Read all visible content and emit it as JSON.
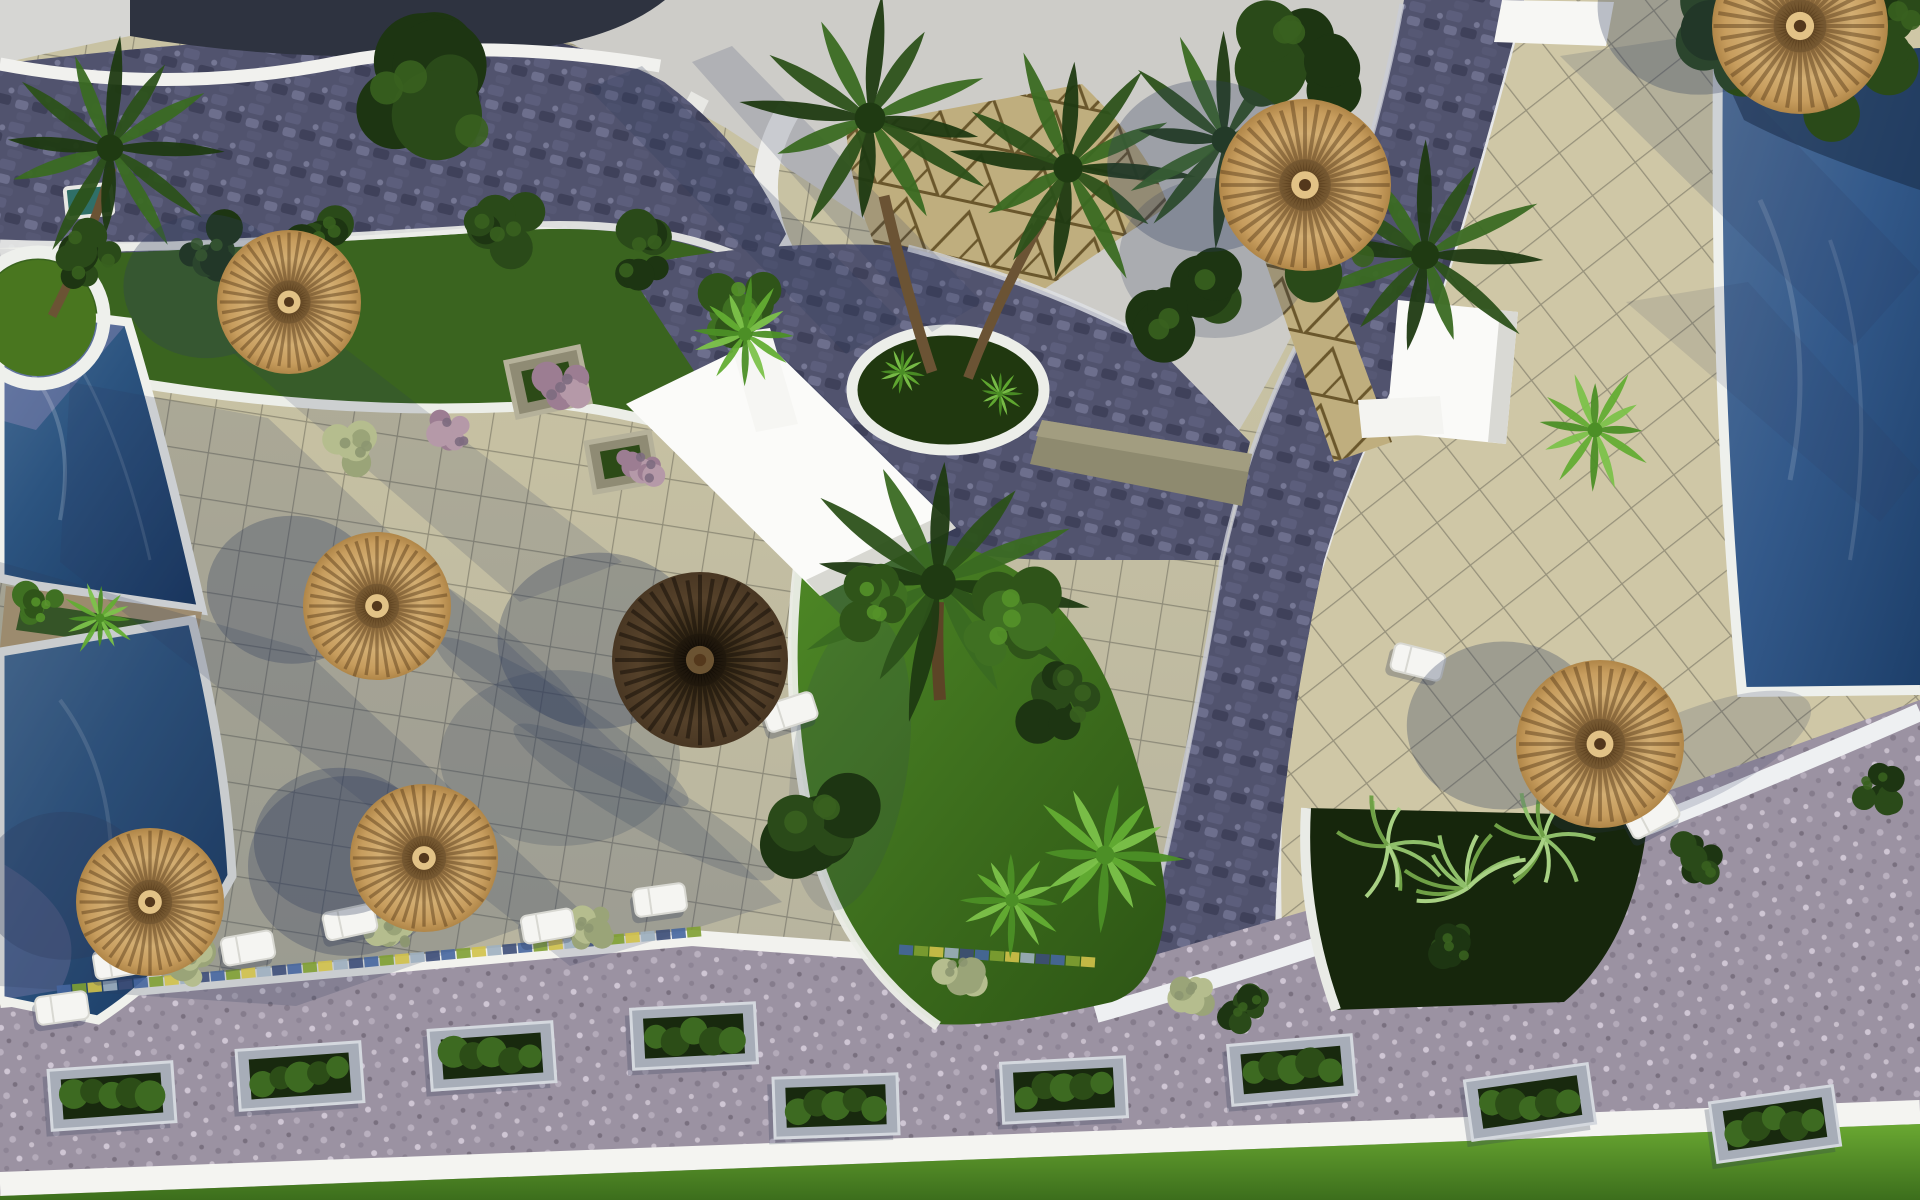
{
  "scene": {
    "title": "aerial-render-resort-courtyard-with-pools-palms-and-thatch-umbrellas",
    "palette": {
      "tile_base": "#c8c2a3",
      "tile_base_right": "#cfc7a6",
      "grout": "#827e6a",
      "cobble_base": "#51536e",
      "cobble_hi": "#6d6f8d",
      "cobble_lo": "#3f415a",
      "road_base": "#9b92a2",
      "road_hi": "#c3bac9",
      "road_lo": "#8a8191",
      "roof_gray": "#cdccc8",
      "white_wall": "#f2f2ee",
      "water_deep": "#15345c",
      "water_mid": "#2c5480",
      "water_light": "#4a6f96",
      "lawn_dark": "#2c5414",
      "lawn_light": "#4e8826",
      "grass_bright": "#6aa832",
      "thatch_light": "#d3ae72",
      "thatch_mid": "#a8834f",
      "thatch_dark_center": "#7e5f35",
      "thatch_brown": "#3a2d18",
      "trunk": "#6b5334",
      "stone": "#8e8a6f",
      "shadow": "#2e3a5c",
      "tri_tile": "#bfae7e",
      "tri_line": "#6a572c"
    },
    "umbrellas": [
      {
        "x": 289,
        "y": 302,
        "r": 72,
        "type": "tan"
      },
      {
        "x": 377,
        "y": 606,
        "r": 74,
        "type": "tan"
      },
      {
        "x": 150,
        "y": 902,
        "r": 74,
        "type": "tan"
      },
      {
        "x": 424,
        "y": 858,
        "r": 74,
        "type": "tan"
      },
      {
        "x": 700,
        "y": 660,
        "r": 88,
        "type": "dark"
      },
      {
        "x": 1305,
        "y": 185,
        "r": 86,
        "type": "tan"
      },
      {
        "x": 1600,
        "y": 744,
        "r": 84,
        "type": "tan"
      },
      {
        "x": 1800,
        "y": 26,
        "r": 88,
        "type": "tan"
      }
    ],
    "loungers": [
      {
        "x": 62,
        "y": 1008,
        "rot": -8
      },
      {
        "x": 120,
        "y": 962,
        "rot": -9
      },
      {
        "x": 248,
        "y": 948,
        "rot": -10
      },
      {
        "x": 350,
        "y": 922,
        "rot": -12
      },
      {
        "x": 548,
        "y": 926,
        "rot": -10
      },
      {
        "x": 660,
        "y": 900,
        "rot": -8
      },
      {
        "x": 790,
        "y": 712,
        "rot": -18
      },
      {
        "x": 1418,
        "y": 662,
        "rot": 14
      },
      {
        "x": 1652,
        "y": 816,
        "rot": -28
      }
    ],
    "planter_boxes": [
      {
        "x": 112,
        "y": 1096,
        "rot": -4
      },
      {
        "x": 300,
        "y": 1076,
        "rot": -4
      },
      {
        "x": 492,
        "y": 1056,
        "rot": -4
      },
      {
        "x": 694,
        "y": 1036,
        "rot": -3
      },
      {
        "x": 836,
        "y": 1106,
        "rot": -2
      },
      {
        "x": 1064,
        "y": 1090,
        "rot": -3
      },
      {
        "x": 1292,
        "y": 1070,
        "rot": -5
      },
      {
        "x": 1530,
        "y": 1102,
        "rot": -8
      },
      {
        "x": 1775,
        "y": 1124,
        "rot": -8
      }
    ],
    "mosaic_segments": [
      {
        "x1": 64,
        "y1": 990,
        "x2": 694,
        "y2": 932,
        "n": 42
      },
      {
        "x1": 906,
        "y1": 950,
        "x2": 1088,
        "y2": 962,
        "n": 13
      }
    ],
    "mosaic_colors": [
      "#46669e",
      "#7fa032",
      "#d2c24a",
      "#9fb0c0",
      "#3d4e78"
    ],
    "shrubs": [
      {
        "s": "palmDark",
        "x": 110,
        "y": 148,
        "r": 112
      },
      {
        "s": "palmDark",
        "x": 870,
        "y": 118,
        "r": 128
      },
      {
        "s": "palmDark",
        "x": 1068,
        "y": 168,
        "r": 122
      },
      {
        "s": "palmDark",
        "x": 938,
        "y": 582,
        "r": 148
      },
      {
        "s": "palmDark",
        "x": 1225,
        "y": 140,
        "r": 112
      },
      {
        "s": "palmDark",
        "x": 1425,
        "y": 255,
        "r": 118
      },
      {
        "s": "bushDark",
        "x": 430,
        "y": 104,
        "r": 92
      },
      {
        "s": "bushDark",
        "x": 90,
        "y": 256,
        "r": 38
      },
      {
        "s": "bushDark",
        "x": 205,
        "y": 248,
        "r": 34
      },
      {
        "s": "bushDark",
        "x": 322,
        "y": 238,
        "r": 36
      },
      {
        "s": "bushDark",
        "x": 502,
        "y": 230,
        "r": 42
      },
      {
        "s": "bushDark",
        "x": 640,
        "y": 252,
        "r": 40
      },
      {
        "s": "bushDark",
        "x": 815,
        "y": 830,
        "r": 64
      },
      {
        "s": "bushDark",
        "x": 1060,
        "y": 700,
        "r": 46
      },
      {
        "s": "bushDark",
        "x": 1718,
        "y": 30,
        "r": 62
      },
      {
        "s": "bushDark",
        "x": 1804,
        "y": 72,
        "r": 72
      },
      {
        "s": "bushDark",
        "x": 1884,
        "y": 34,
        "r": 56
      },
      {
        "s": "bushDark",
        "x": 1300,
        "y": 58,
        "r": 66
      },
      {
        "s": "bushDark",
        "x": 1186,
        "y": 302,
        "r": 58
      },
      {
        "s": "bushDark",
        "x": 1332,
        "y": 250,
        "r": 62
      },
      {
        "s": "bushDark",
        "x": 1244,
        "y": 1008,
        "r": 26
      },
      {
        "s": "bushDark",
        "x": 1452,
        "y": 944,
        "r": 28
      },
      {
        "s": "bushDark",
        "x": 1700,
        "y": 860,
        "r": 28
      },
      {
        "s": "bushDark",
        "x": 1878,
        "y": 790,
        "r": 26
      },
      {
        "s": "bushMid",
        "x": 1010,
        "y": 622,
        "r": 50
      },
      {
        "s": "bushMid",
        "x": 880,
        "y": 600,
        "r": 40
      },
      {
        "s": "bushMid",
        "x": 40,
        "y": 610,
        "r": 26
      },
      {
        "s": "bushMid",
        "x": 740,
        "y": 306,
        "r": 40
      },
      {
        "s": "palmBright",
        "x": 1105,
        "y": 855,
        "r": 78
      },
      {
        "s": "palmBright",
        "x": 1595,
        "y": 430,
        "r": 62
      },
      {
        "s": "palmBright",
        "x": 745,
        "y": 334,
        "r": 56
      },
      {
        "s": "palmBright",
        "x": 100,
        "y": 618,
        "r": 38
      },
      {
        "s": "palmBright",
        "x": 902,
        "y": 372,
        "r": 26
      },
      {
        "s": "palmBright",
        "x": 1000,
        "y": 394,
        "r": 24
      },
      {
        "s": "palmBright",
        "x": 1012,
        "y": 900,
        "r": 56
      },
      {
        "s": "fern",
        "x": 1388,
        "y": 846,
        "r": 56
      },
      {
        "s": "fern",
        "x": 1468,
        "y": 888,
        "r": 60
      },
      {
        "s": "fern",
        "x": 1544,
        "y": 838,
        "r": 52
      },
      {
        "s": "pampas",
        "x": 190,
        "y": 960,
        "r": 30
      },
      {
        "s": "pampas",
        "x": 392,
        "y": 938,
        "r": 28
      },
      {
        "s": "pampas",
        "x": 592,
        "y": 930,
        "r": 26
      },
      {
        "s": "pampas",
        "x": 960,
        "y": 970,
        "r": 26
      },
      {
        "s": "pampas",
        "x": 1190,
        "y": 996,
        "r": 26
      },
      {
        "s": "pampas",
        "x": 352,
        "y": 452,
        "r": 30
      },
      {
        "s": "pink",
        "x": 565,
        "y": 388,
        "r": 30
      },
      {
        "s": "pink",
        "x": 640,
        "y": 468,
        "r": 26
      },
      {
        "s": "pink",
        "x": 452,
        "y": 432,
        "r": 26
      }
    ],
    "shadows": {
      "polys": [
        {
          "pts": [
            [
              70,
              382
            ],
            [
              268,
              418
            ],
            [
              782,
              902
            ],
            [
              570,
              966
            ],
            [
              60,
              562
            ]
          ],
          "op": 0.18
        },
        {
          "pts": [
            [
              0,
              562
            ],
            [
              302,
              648
            ],
            [
              578,
              908
            ],
            [
              296,
              1006
            ],
            [
              0,
              986
            ]
          ],
          "op": 0.2
        },
        {
          "pts": [
            [
              1560,
              56
            ],
            [
              1692,
              36
            ],
            [
              1920,
              272
            ],
            [
              1854,
              346
            ]
          ],
          "op": 0.16
        },
        {
          "pts": [
            [
              1626,
              302
            ],
            [
              1748,
              282
            ],
            [
              1920,
              472
            ],
            [
              1880,
              522
            ]
          ],
          "op": 0.12
        },
        {
          "pts": [
            [
              588,
              88
            ],
            [
              642,
              66
            ],
            [
              902,
              322
            ],
            [
              846,
              354
            ]
          ],
          "op": 0.24
        },
        {
          "pts": [
            [
              692,
              62
            ],
            [
              732,
              46
            ],
            [
              982,
              302
            ],
            [
              932,
              332
            ]
          ],
          "op": 0.18
        },
        {
          "pts": [
            [
              232,
              352
            ],
            [
              342,
              346
            ],
            [
              622,
              562
            ],
            [
              520,
              602
            ]
          ],
          "op": 0.16
        }
      ],
      "ells": [
        {
          "x": 348,
          "y": 866,
          "rx": 100,
          "ry": 90,
          "rot": 0,
          "op": 0.28
        },
        {
          "x": 560,
          "y": 758,
          "rx": 120,
          "ry": 88,
          "rot": 0,
          "op": 0.2
        },
        {
          "x": 1215,
          "y": 258,
          "rx": 96,
          "ry": 80,
          "rot": 0,
          "op": 0.22
        },
        {
          "x": 480,
          "y": 642,
          "rx": 132,
          "ry": 26,
          "rot": 38,
          "op": 0.22
        },
        {
          "x": 562,
          "y": 722,
          "rx": 150,
          "ry": 27,
          "rot": 33,
          "op": 0.22
        },
        {
          "x": 644,
          "y": 802,
          "rx": 150,
          "ry": 27,
          "rot": 30,
          "op": 0.2
        },
        {
          "x": 1680,
          "y": 762,
          "rx": 142,
          "ry": 46,
          "rot": -24,
          "op": 0.18
        },
        {
          "x": 850,
          "y": 762,
          "rx": 58,
          "ry": 150,
          "rot": 8,
          "op": 0.15
        }
      ]
    }
  }
}
